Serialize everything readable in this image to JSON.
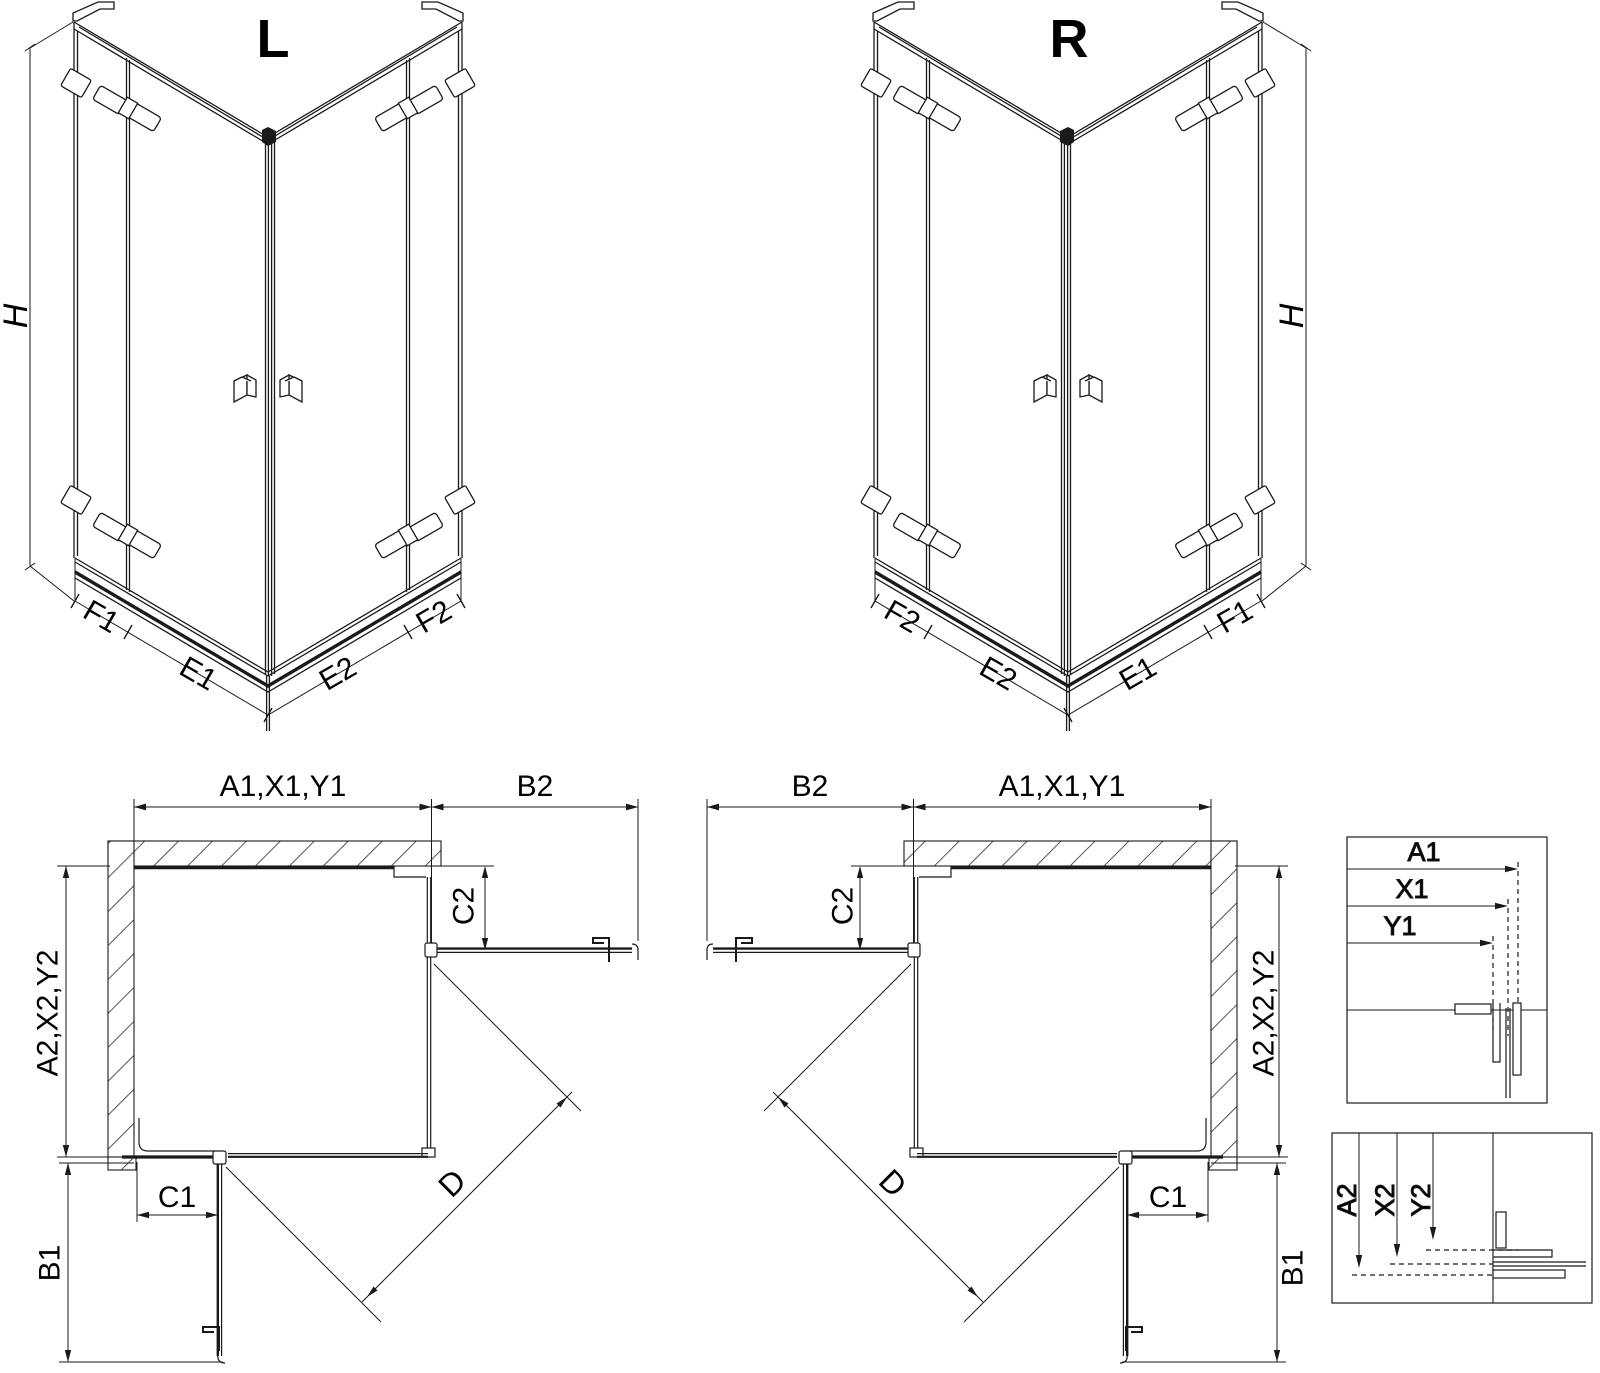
{
  "drawing": {
    "variant_left": {
      "title": "L"
    },
    "variant_right": {
      "title": "R"
    },
    "labels": {
      "height": "H",
      "f1": "F1",
      "e1": "E1",
      "e2": "E2",
      "f2": "F2",
      "width_top": "A1,X1,Y1",
      "width_return": "B2",
      "depth_side": "A2,X2,Y2",
      "c1": "C1",
      "c2": "C2",
      "b1": "B1",
      "diagonal": "D"
    },
    "detail_width": {
      "a1": "A1",
      "x1": "X1",
      "y1": "Y1"
    },
    "detail_depth": {
      "a2": "A2",
      "x2": "X2",
      "y2": "Y2"
    },
    "colors": {
      "line": "#1a1a1a",
      "background": "#ffffff"
    }
  }
}
